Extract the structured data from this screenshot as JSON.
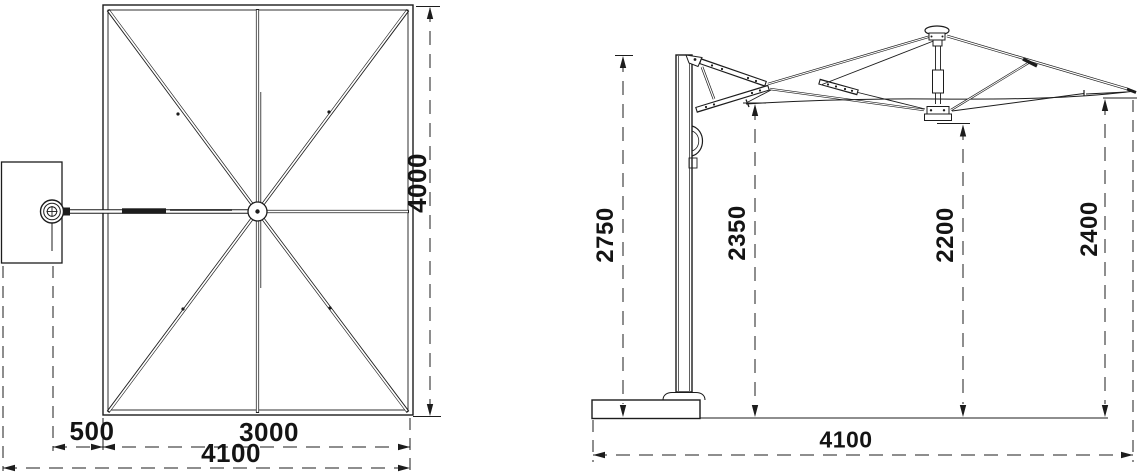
{
  "drawing": {
    "type": "technical-dimension-drawing",
    "subject": "cantilever patio umbrella",
    "palette": {
      "line": "#1c1c1c",
      "background": "#ffffff"
    },
    "views": {
      "plan": {
        "name": "top view (canopy plan)",
        "dims": {
          "canopy_depth": "4000",
          "pole_offset": "500",
          "canopy_width": "3000",
          "overall_width": "4100"
        }
      },
      "elevation": {
        "name": "side view (elevation)",
        "dims": {
          "pole_height": "2750",
          "edge_clearance_left": "2350",
          "hub_clearance": "2200",
          "edge_clearance_right": "2400",
          "overall_span": "4100"
        }
      }
    }
  }
}
